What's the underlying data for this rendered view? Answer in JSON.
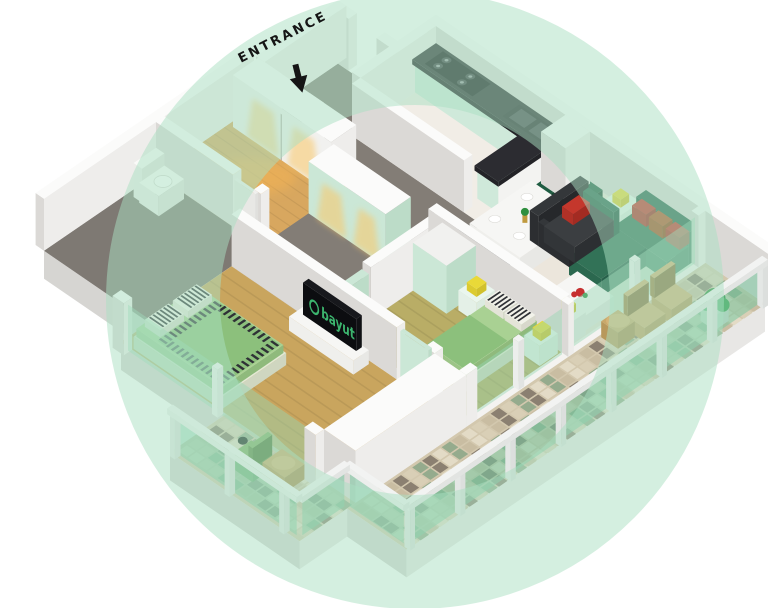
{
  "entrance": {
    "label": "ENTRANCE",
    "arrow_icon": "down-arrow-icon"
  },
  "tv": {
    "logo_text": "bayut",
    "logo_icon": "bayut-logo-icon",
    "screen_color": "#17181c",
    "logo_color": "#3cb56e"
  },
  "watermark": {
    "shape": "ring",
    "color": "#a9dfc2",
    "opacity": "0.5"
  },
  "palette": {
    "walls": {
      "top": "#fbfbfa",
      "side_u": "#eeedeb",
      "side_v": "#dbd9d6"
    },
    "plinth": {
      "side_u": "#e8e7e5",
      "side_v": "#d6d5d2",
      "sub": "#f4f3f1"
    },
    "floors": {
      "hall": "#837d76",
      "corridor": "#837d76",
      "kitchen": "#f1ede6",
      "living": "#ece6dc",
      "dressing": "#d8a75f",
      "bathroom": "#7e7973",
      "master": "#b9ad66",
      "bedroom2": "#c9a55e",
      "balcony": "#d3c8ae",
      "plank_shadow": "rgba(0,0,0,0.07)"
    },
    "tiles": [
      "#d9cfb6",
      "#95ab8d",
      "#c9bda2",
      "#8b8071",
      "#e3dbc6"
    ],
    "glass": {
      "panel": "rgba(150,214,180,0.45)",
      "deep": "rgba(120,198,160,0.55)",
      "frame": "#f2f3f2",
      "post": "#e9ecea"
    },
    "counter": {
      "top": "#2c2c31",
      "side": "#232327",
      "cabinet": "#cfe9da",
      "cabinet_u": "#bfdfcc",
      "stove": "#17171b",
      "sink": "#26262b",
      "sink_basin": "#44444b",
      "leg_white": "#f3f3f1"
    },
    "sofa": {
      "charcoal": "#34373a",
      "charcoal_top": "#3b3e41",
      "green": "#2a6750",
      "green_seat": "#327257",
      "pillow_red": "#c4372c",
      "pillow_orange": "#b25327"
    },
    "tables": {
      "white": "#f6f6f4",
      "white_side": "#e8e8e5",
      "wood": "#c9a86a",
      "mint": "#eaf6ee"
    },
    "chairs": {
      "dining_green": "#1f5c42",
      "dining_black": "#2c2e30",
      "balcony_tan": "#d2b176",
      "balcony_green": "#7fae66",
      "frame_dark": "#3a3a38"
    },
    "bed": {
      "base": "#e3e9d5",
      "mattress": "#a9d193",
      "blanket": "#8cc07c",
      "pillow": "#f2f2ea",
      "stripe": "#2f3136"
    },
    "wardrobe": {
      "mint": "#cbe7d6",
      "mint_u": "#bcdcc8",
      "white": "#f1f1ef"
    },
    "accents": {
      "lamp_yellow": "#e9d938",
      "plant_green": "#2f8f3e",
      "plant_green2": "#46a854",
      "flower_red": "#c62f2f",
      "glow": "rgba(250,198,104,0.55)",
      "floor_glow": "rgba(244,178,82,0.55)",
      "toilet": "#fafaf8"
    }
  }
}
